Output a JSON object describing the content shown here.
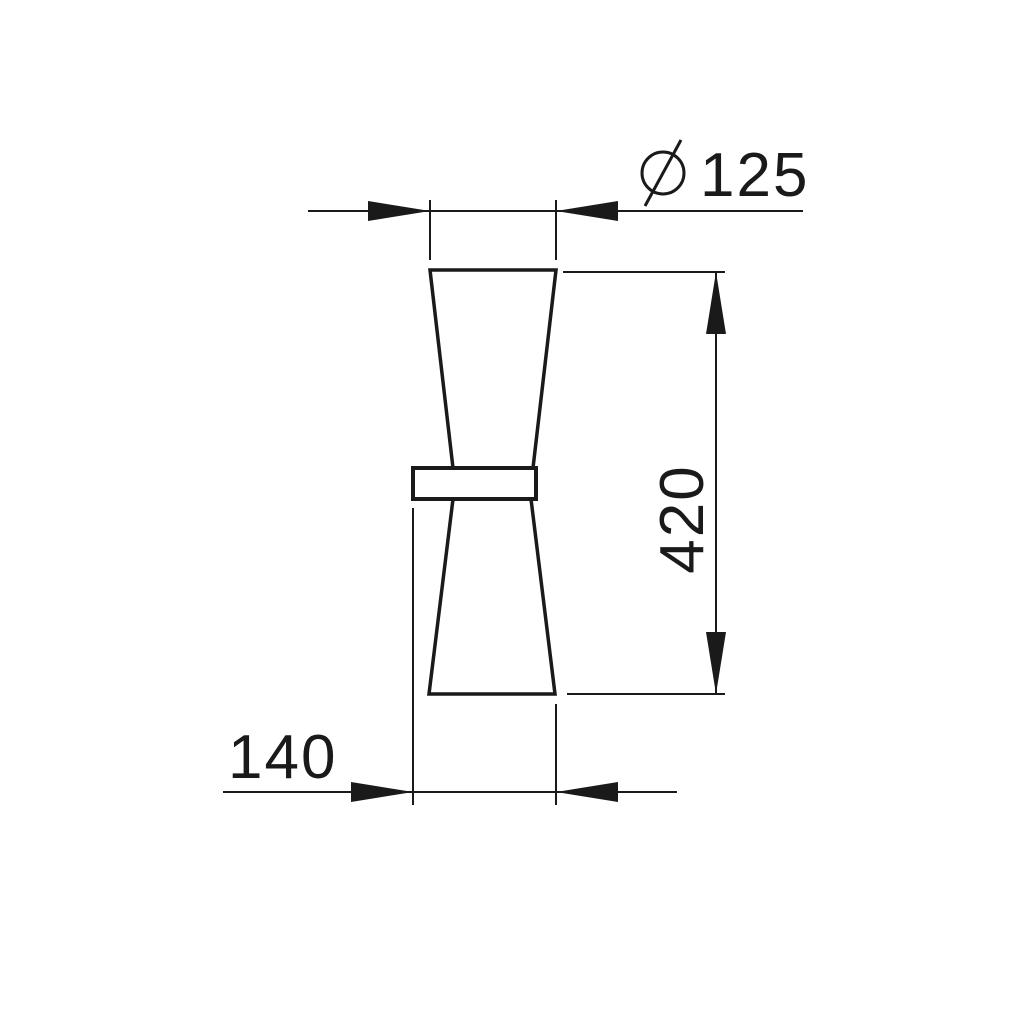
{
  "drawing": {
    "title": "Double-cone wall luminaire dimensional drawing",
    "object_name": "double-cone-wall-light-side-view",
    "colors": {
      "line": "#1a1a1a",
      "background": "#ffffff",
      "fill": "#ffffff"
    },
    "dimensions": {
      "diameter": {
        "symbol": "diameter-sign",
        "value": "125",
        "label": "Ø 125",
        "orientation": "horizontal-top"
      },
      "height": {
        "value": "420",
        "orientation": "vertical-right",
        "text_rotation_deg": -90
      },
      "depth": {
        "value": "140",
        "orientation": "horizontal-bottom"
      }
    }
  }
}
